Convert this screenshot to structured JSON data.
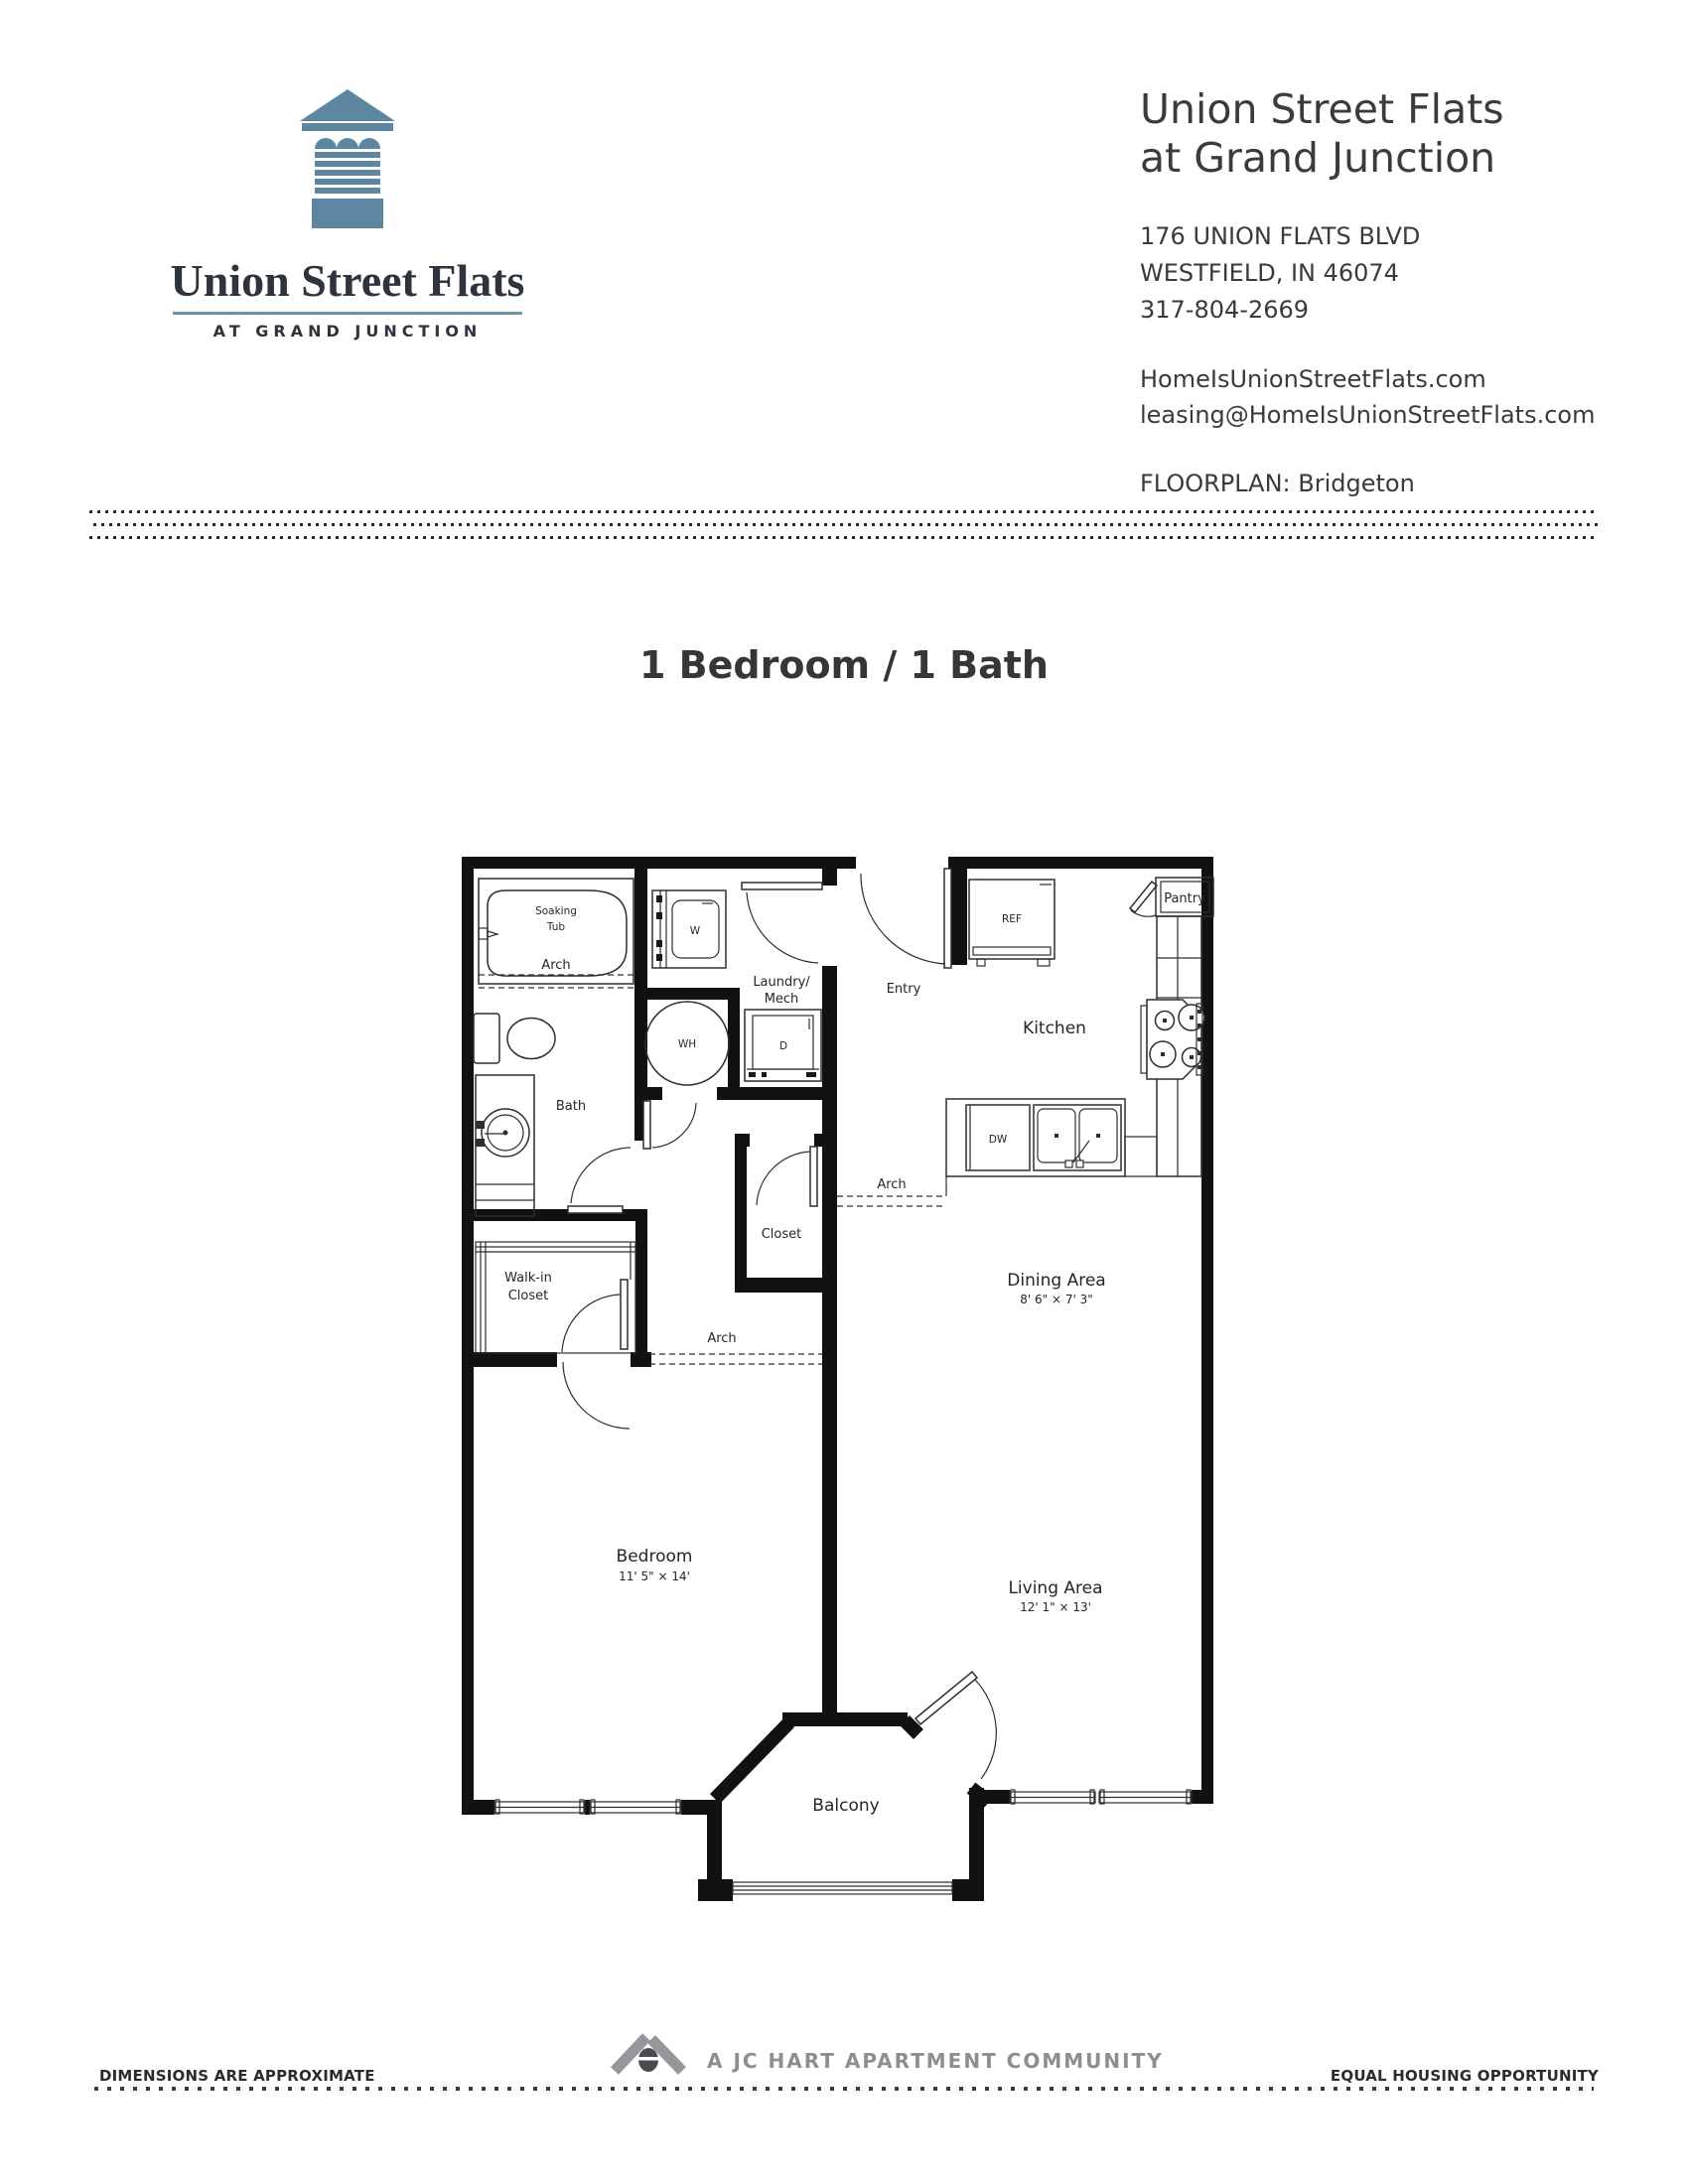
{
  "brand": {
    "name": "Union Street Flats",
    "tagline": "AT GRAND JUNCTION"
  },
  "property": {
    "title_line1": "Union Street Flats",
    "title_line2": "at Grand Junction",
    "address_line1": "176 UNION FLATS BLVD",
    "address_line2": "WESTFIELD, IN 46074",
    "phone": "317-804-2669",
    "website": "HomeIsUnionStreetFlats.com",
    "email": "leasing@HomeIsUnionStreetFlats.com",
    "floorplan_label": "FLOORPLAN:",
    "floorplan_name": "Bridgeton"
  },
  "plan": {
    "title": "1 Bedroom / 1 Bath"
  },
  "floorplan": {
    "arch": "Arch",
    "rooms": {
      "kitchen": "Kitchen",
      "entry": "Entry",
      "laundry_line1": "Laundry/",
      "laundry_line2": "Mech",
      "bath": "Bath",
      "closet": "Closet",
      "walkin_line1": "Walk-in",
      "walkin_line2": "Closet",
      "dining": "Dining Area",
      "dining_dims": "8' 6\" × 7' 3\"",
      "bedroom": "Bedroom",
      "bedroom_dims": "11' 5\" × 14'",
      "living": "Living Area",
      "living_dims": "12' 1\" × 13'",
      "balcony": "Balcony"
    },
    "fixtures": {
      "soaking_line1": "Soaking",
      "soaking_line2": "Tub",
      "washer": "W",
      "dryer": "D",
      "water_heater": "WH",
      "refrigerator": "REF",
      "dishwasher": "DW",
      "pantry": "Pantry"
    }
  },
  "footer": {
    "left": "DIMENSIONS ARE APPROXIMATE",
    "center": "A JC HART APARTMENT COMMUNITY",
    "right": "EQUAL HOUSING OPPORTUNITY"
  },
  "colors": {
    "logo_blue": "#5d87a1",
    "footer_gray": "#97979b",
    "footer_dark": "#4a4a4e"
  }
}
